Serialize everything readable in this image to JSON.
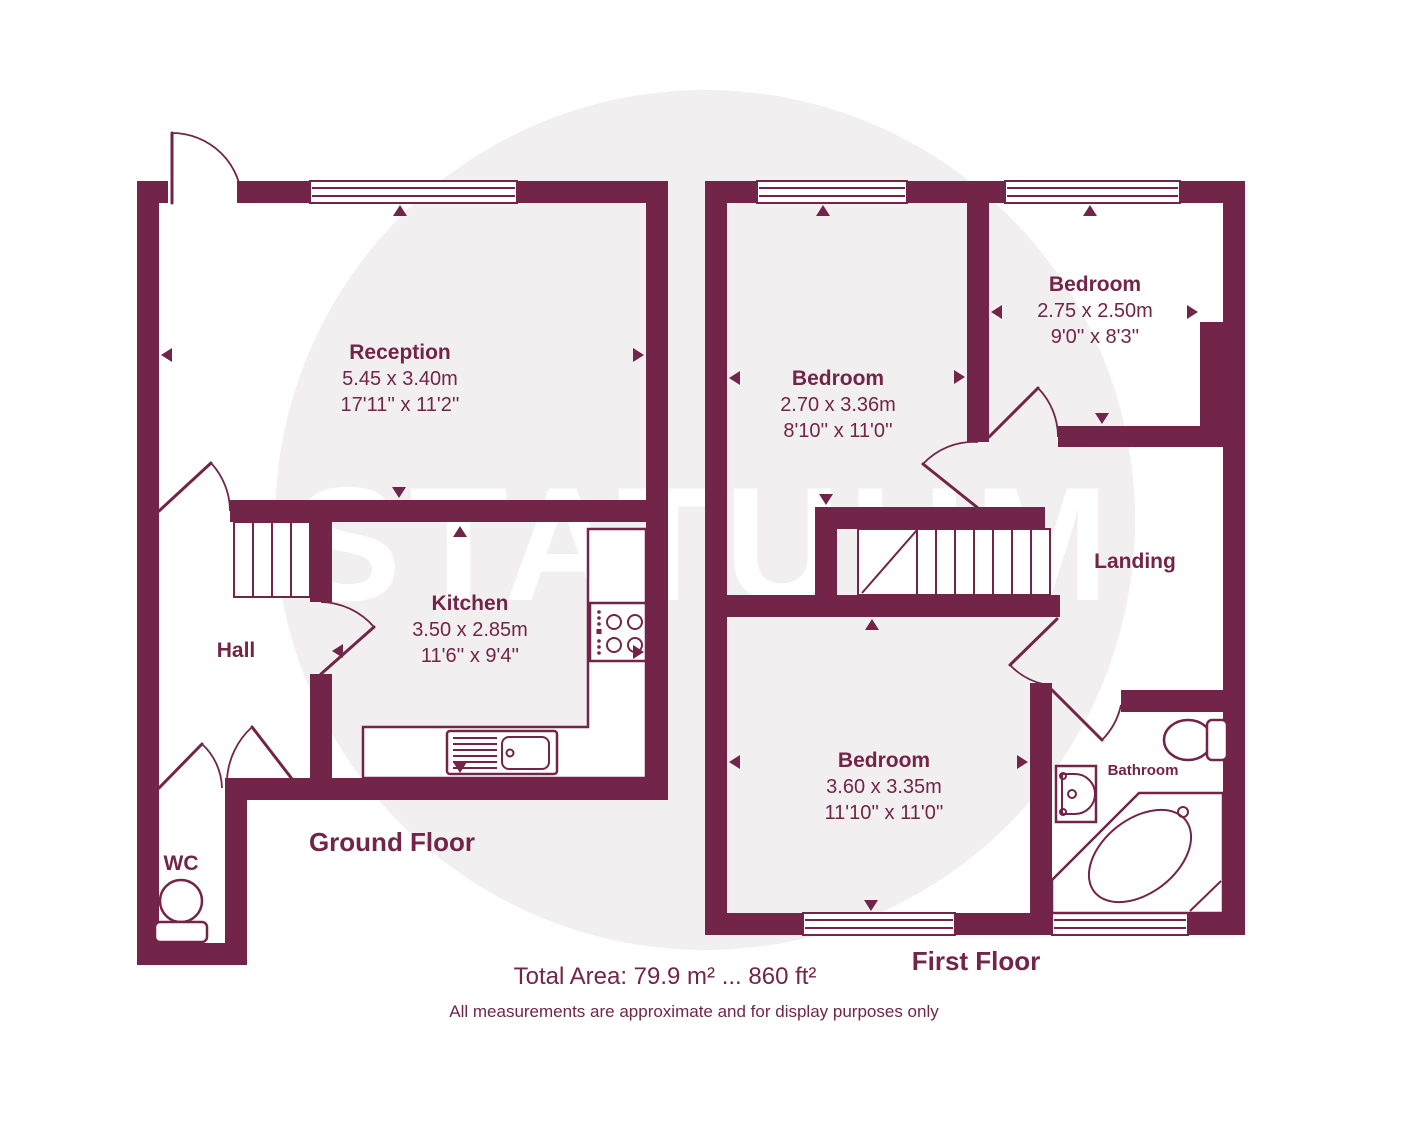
{
  "colors": {
    "wall": "#722549",
    "circle": "#f1eff0",
    "text": "#722549"
  },
  "watermark": {
    "text": "STATUUM"
  },
  "ground_floor": {
    "label": "Ground Floor",
    "rooms": {
      "reception": {
        "name": "Reception",
        "dim_m": "5.45 x 3.40m",
        "dim_ft": "17'11'' x 11'2''"
      },
      "kitchen": {
        "name": "Kitchen",
        "dim_m": "3.50 x 2.85m",
        "dim_ft": "11'6'' x 9'4''"
      },
      "hall": {
        "name": "Hall"
      },
      "wc": {
        "name": "WC"
      }
    }
  },
  "first_floor": {
    "label": "First Floor",
    "rooms": {
      "bedroom_left": {
        "name": "Bedroom",
        "dim_m": "2.70 x 3.36m",
        "dim_ft": "8'10'' x 11'0''"
      },
      "bedroom_right": {
        "name": "Bedroom",
        "dim_m": "2.75 x 2.50m",
        "dim_ft": "9'0'' x 8'3''"
      },
      "bedroom_bottom": {
        "name": "Bedroom",
        "dim_m": "3.60 x 3.35m",
        "dim_ft": "11'10'' x 11'0''"
      },
      "landing": {
        "name": "Landing"
      },
      "bathroom": {
        "name": "Bathroom"
      }
    }
  },
  "footer": {
    "total_area": "Total Area: 79.9 m² ... 860 ft²",
    "disclaimer": "All measurements are approximate and for display purposes only"
  }
}
